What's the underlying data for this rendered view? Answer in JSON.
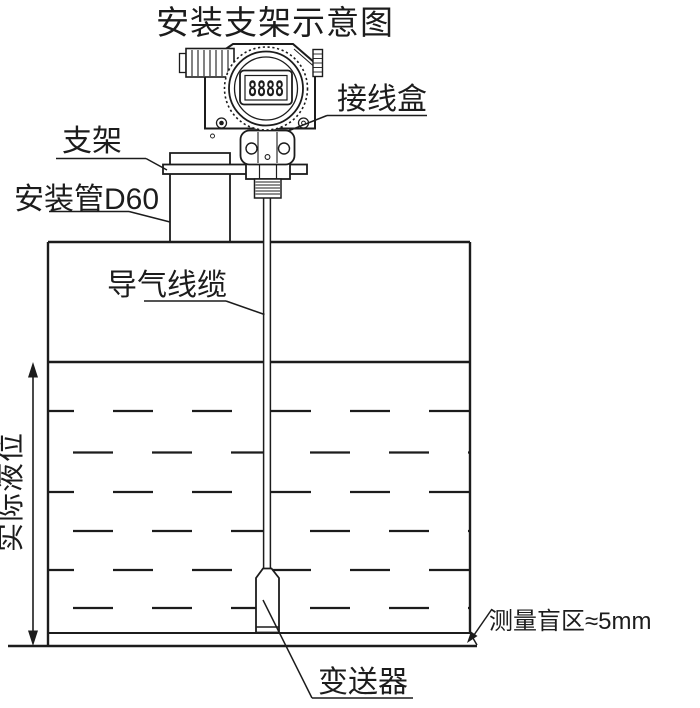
{
  "title": "安装支架示意图",
  "display": {
    "value": "8888"
  },
  "labels": {
    "junction_box": "接线盒",
    "bracket": "支架",
    "mounting_pipe": "安装管D60",
    "air_cable": "导气线缆",
    "actual_level": "实际液位",
    "blind_zone": "测量盲区≈5mm",
    "transmitter": "变送器"
  },
  "colors": {
    "line": "#1c1c1c",
    "background": "#ffffff"
  }
}
